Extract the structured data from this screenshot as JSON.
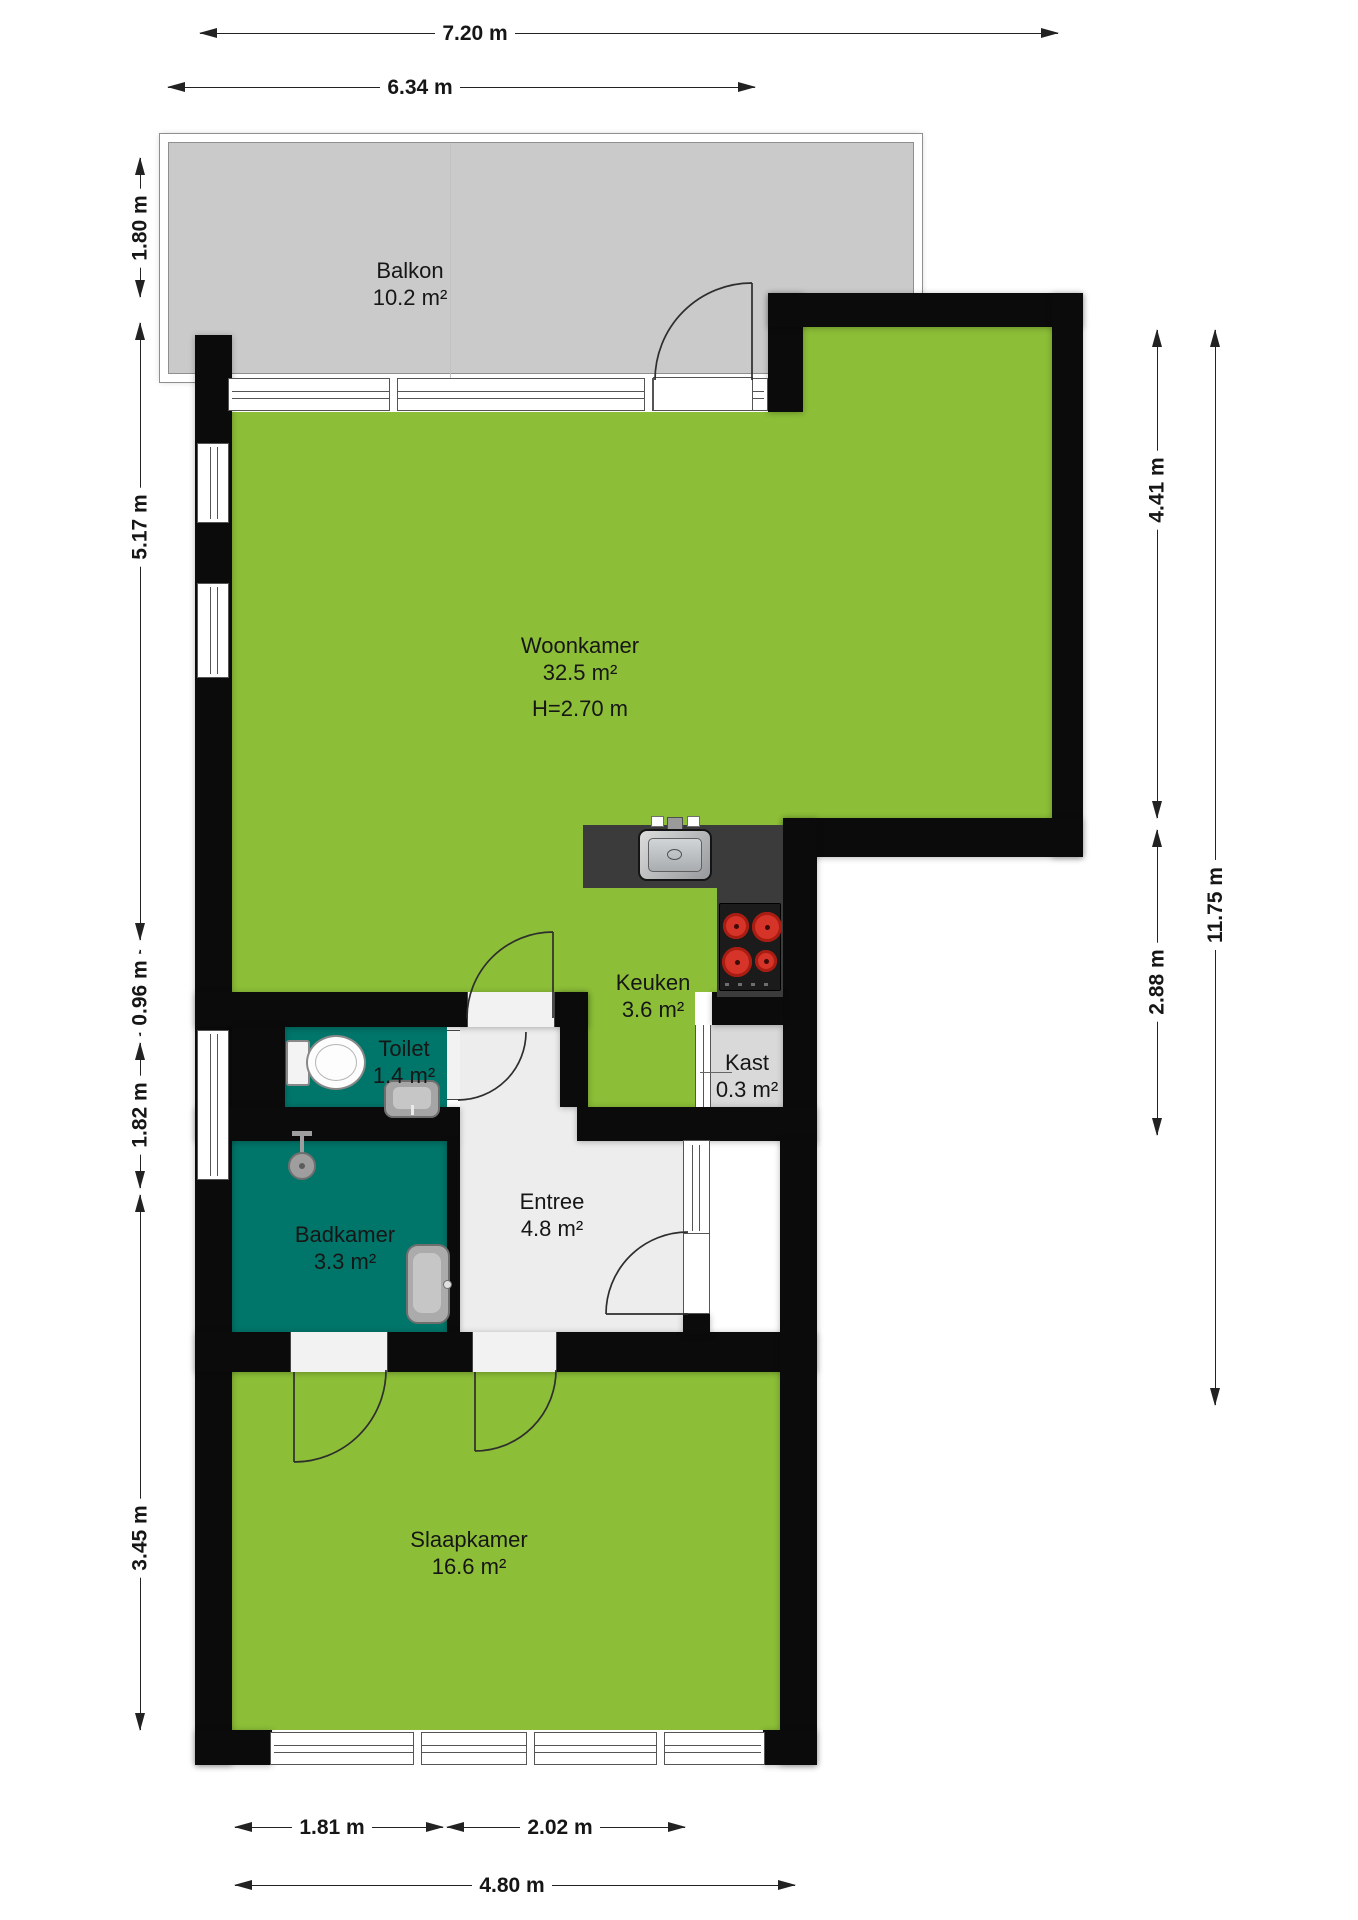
{
  "plan_type": "floorplan",
  "colors": {
    "room_green": "#8cbe37",
    "room_teal": "#007569",
    "balcony_gray": "#cacaca",
    "wall_black": "#0b0b0b",
    "entree_gray": "#ededed",
    "kast_gray": "#d9d9d9",
    "counter_dark": "#3b3b3b",
    "burner_red": "#d63428",
    "fixture_gray": "#a5a5a5",
    "text_dark": "#161616"
  },
  "rooms": {
    "balkon": {
      "name": "Balkon",
      "area": "10.2 m²"
    },
    "woonkamer": {
      "name": "Woonkamer",
      "area": "32.5 m²",
      "ceiling_height": "H=2.70 m"
    },
    "keuken": {
      "name": "Keuken",
      "area": "3.6 m²"
    },
    "kast": {
      "name": "Kast",
      "area": "0.3 m²"
    },
    "toilet": {
      "name": "Toilet",
      "area": "1.4 m²"
    },
    "badkamer": {
      "name": "Badkamer",
      "area": "3.3 m²"
    },
    "entree": {
      "name": "Entree",
      "area": "4.8 m²"
    },
    "slaapkamer": {
      "name": "Slaapkamer",
      "area": "16.6 m²"
    }
  },
  "dimensions": {
    "top_outer": "7.20 m",
    "top_inner": "6.34 m",
    "left_balcony": "1.80 m",
    "left_woonkamer": "5.17 m",
    "left_toilet": "0.96 m",
    "left_badkamer": "1.82 m",
    "left_slaapkamer": "3.45 m",
    "right_woonkamer": "4.41 m",
    "right_total": "11.75 m",
    "right_kitchen": "2.88 m",
    "bottom_window_left": "1.81 m",
    "bottom_window_right": "2.02 m",
    "bottom_total": "4.80 m"
  }
}
